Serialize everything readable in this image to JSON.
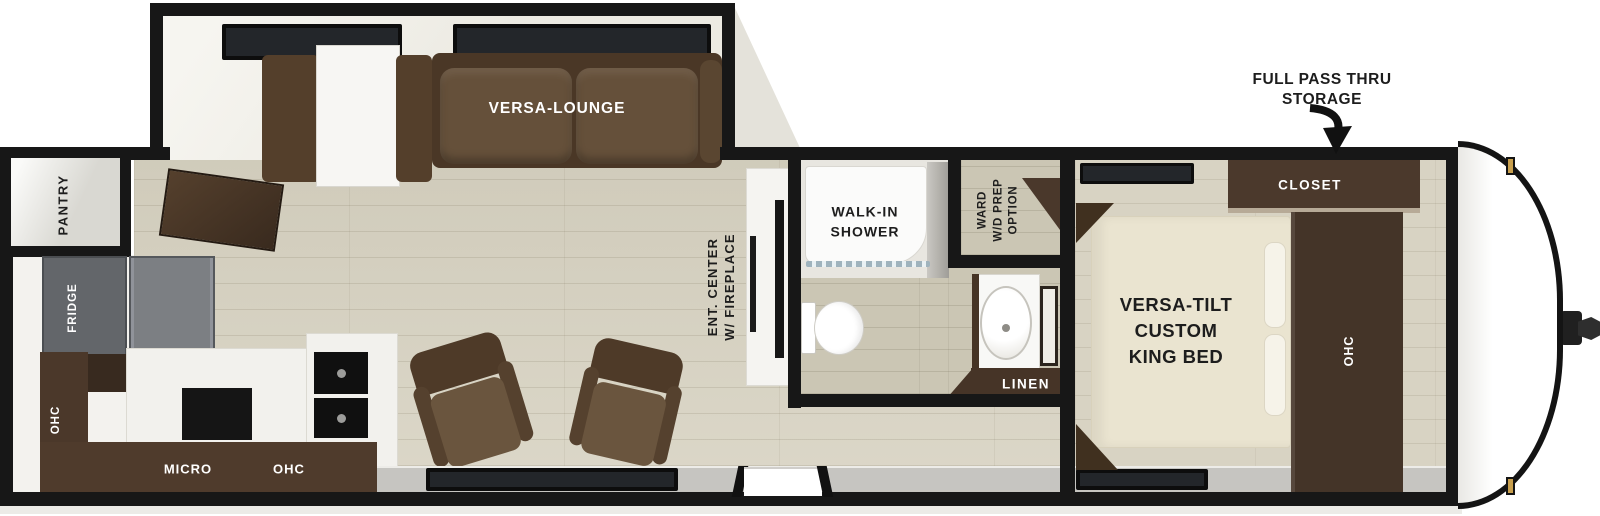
{
  "labels": {
    "lounge": "VERSA-LOUNGE",
    "pantry": "PANTRY",
    "fridge": "FRIDGE",
    "ohc_rear": "OHC",
    "micro": "MICRO",
    "ohc_kitchen": "OHC",
    "ent_center_1": "ENT. CENTER",
    "ent_center_2": "W/ FIREPLACE",
    "shower_1": "WALK-IN",
    "shower_2": "SHOWER",
    "ward_1": "WARD",
    "ward_2": "W/D PREP",
    "ward_3": "OPTION",
    "linen": "LINEN",
    "bed_1": "VERSA-TILT",
    "bed_2": "CUSTOM",
    "bed_3": "KING BED",
    "closet": "CLOSET",
    "ohc_bedroom": "OHC",
    "callout_1": "FULL PASS THRU",
    "callout_2": "STORAGE"
  },
  "colors": {
    "wall": "#171717",
    "floor": "#d7d2c1",
    "bath_floor": "#cbc6b4",
    "cabinet_dark_brown": "#4b382a",
    "sofa_brown": "#5e4933",
    "fridge_gray": "#6c6f73",
    "window_glass": "#23262a",
    "marker_gold": "#c89f4d",
    "exterior_band_gray": "#c6c5c1",
    "label_light": "#ffffff",
    "label_dark": "#1d1d1d"
  }
}
